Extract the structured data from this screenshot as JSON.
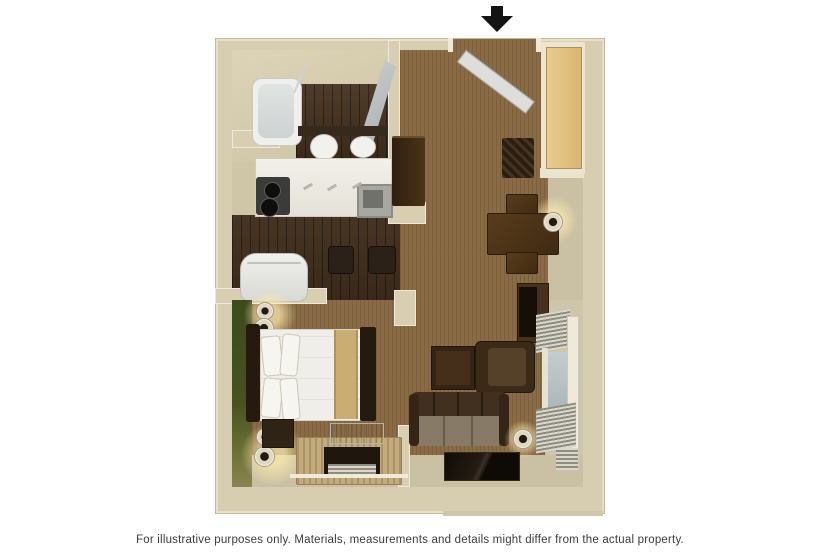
{
  "page": {
    "background": "#ffffff"
  },
  "entrance_arrow": {
    "meaning": "unit entrance",
    "color": "#141414"
  },
  "caption": {
    "text": "For illustrative purposes only.  Materials, measurements and details might differ from the actual property."
  },
  "floorplan": {
    "type": "3d-floor-plan",
    "palette": {
      "wall": "#d7ceb1",
      "wood_floor": "#46321f",
      "carpet": "#8a6b45",
      "vinyl_floor": "#cac1a4",
      "accent_wall_green": "#44501f",
      "counter_white": "#f0eee8",
      "furniture_dark_brown": "#3a2816",
      "window_glass": "#b9c3c6"
    },
    "rooms": [
      "bathroom",
      "kitchen",
      "bedroom",
      "living-dining-area",
      "entry-hall",
      "closet"
    ],
    "furniture": [
      "bathtub",
      "shower-door",
      "toilet",
      "bathroom-sink",
      "vanity-mirror",
      "kitchen-counter",
      "stove",
      "kitchen-sink",
      "refrigerator",
      "bar-stools",
      "closet-door",
      "entry-door",
      "dresser",
      "luggage-rack",
      "dining-table",
      "dining-chairs",
      "table-lamp",
      "television",
      "tv-console",
      "armchair",
      "end-table",
      "sofa",
      "floor-lamp",
      "coffee-table",
      "window-blinds",
      "bed",
      "headboard",
      "pillows",
      "nightstand",
      "wall-sconce-lamps",
      "desk-console",
      "air-conditioner"
    ]
  }
}
